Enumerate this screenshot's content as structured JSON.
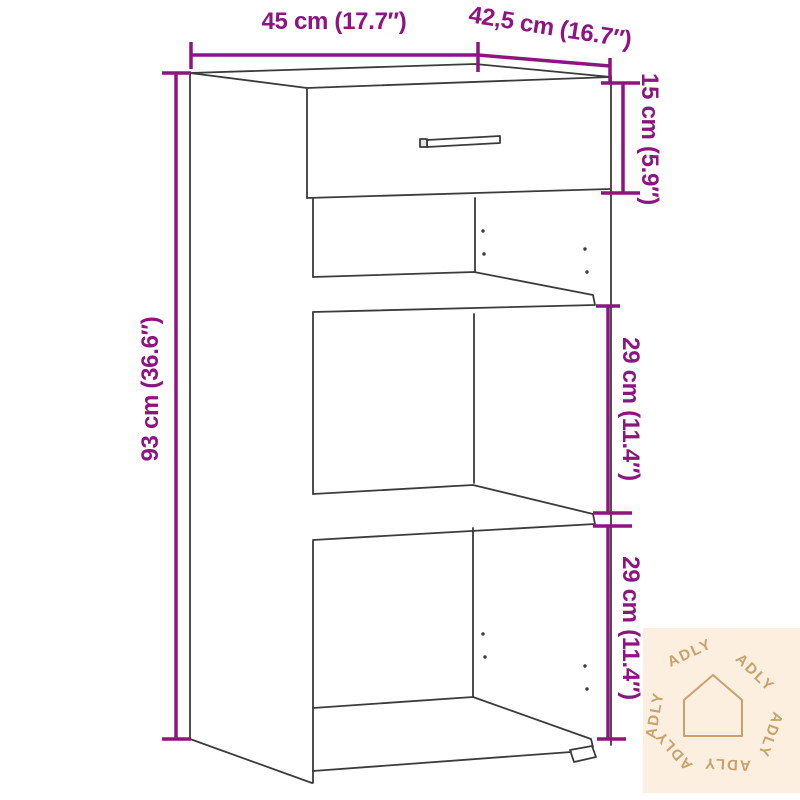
{
  "diagram": {
    "type": "furniture-dimension-drawing",
    "accent_color": "#8e1482",
    "outline_color": "#3b3b3b",
    "dimensions": {
      "width_label": "45 cm (17.7″)",
      "depth_label": "42,5 cm (16.7″)",
      "drawer_height_label": "15 cm (5.9″)",
      "overall_height_label": "93 cm (36.6″)",
      "upper_compartment_label": "29 cm (11.4″)",
      "lower_compartment_label": "29 cm (11.4″)"
    }
  },
  "watermark": {
    "brand": "ADLY",
    "background_color": "#fcefdf",
    "foreground_color": "#c8a26b",
    "icon": "house-outline-icon"
  }
}
